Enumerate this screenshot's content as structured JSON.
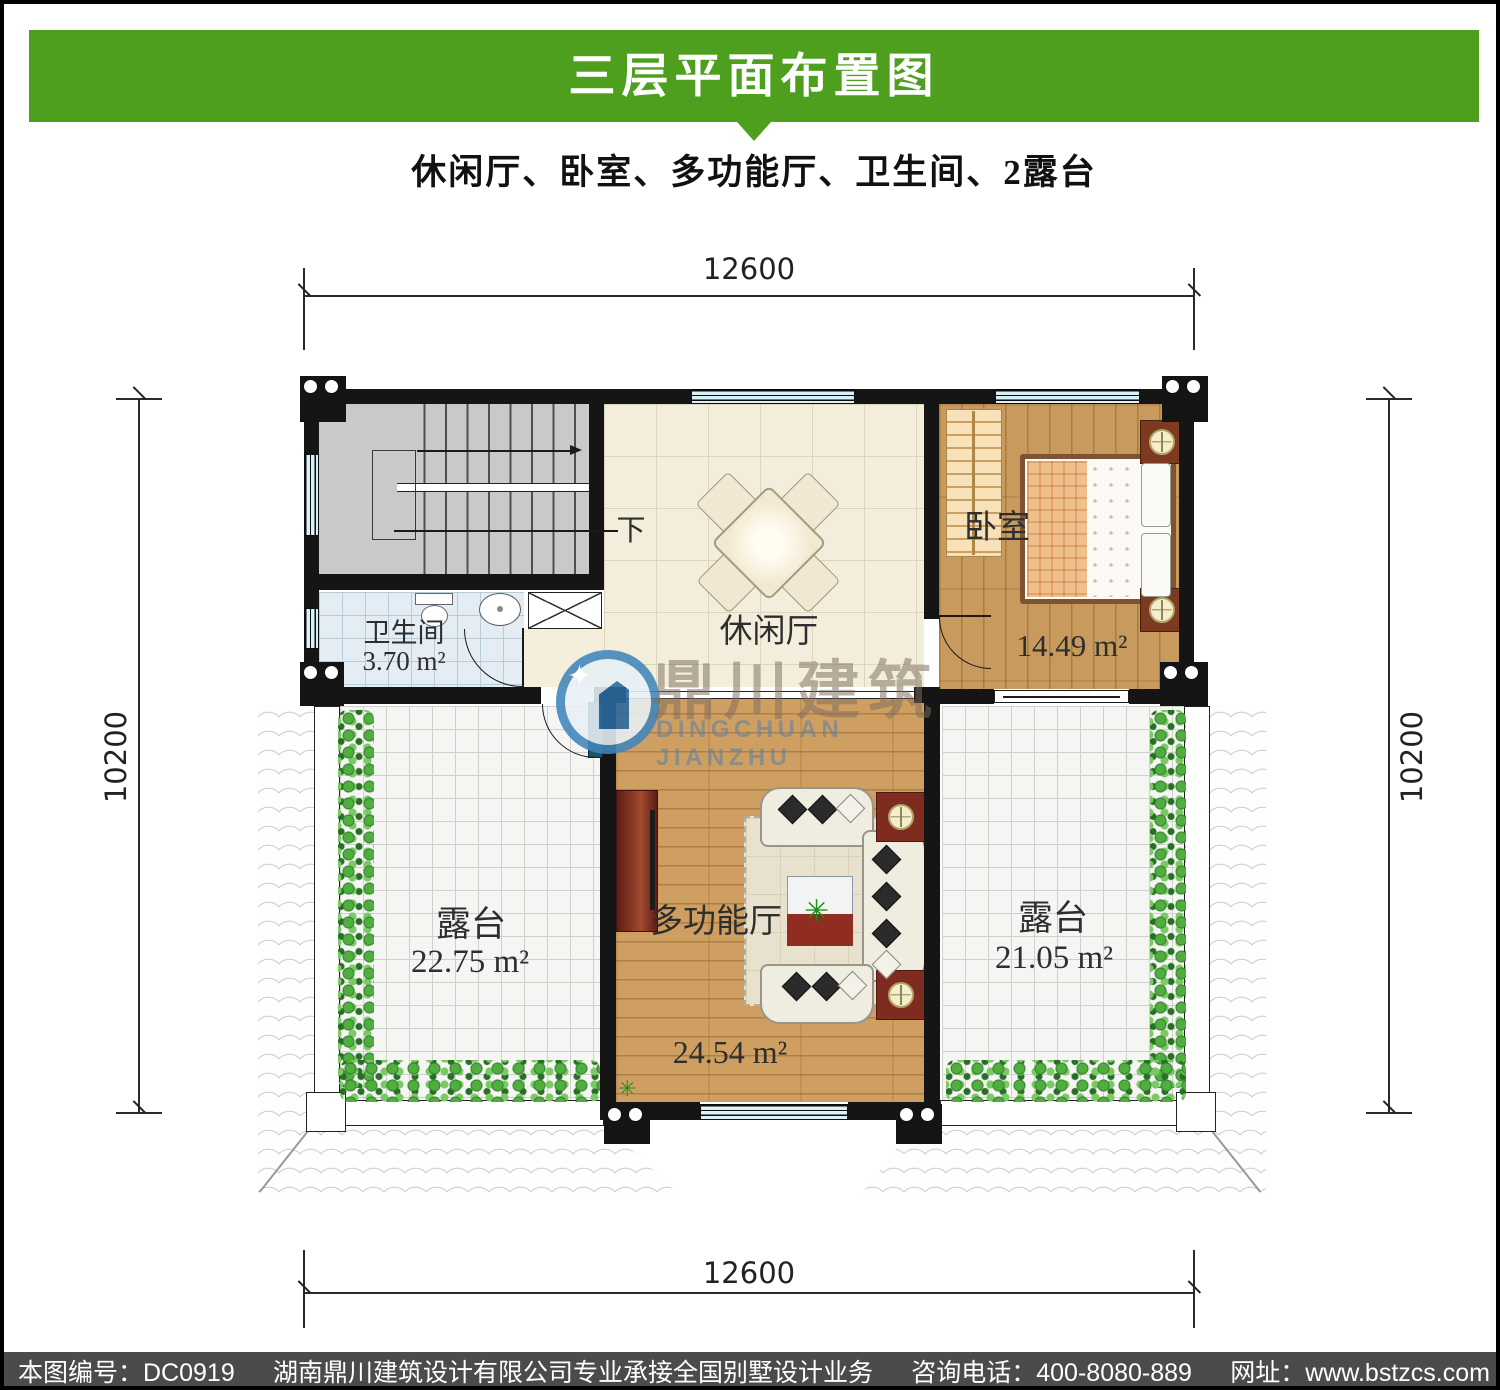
{
  "header": {
    "title": "三层平面布置图",
    "subtitle": "休闲厅、卧室、多功能厅、卫生间、2露台"
  },
  "plan": {
    "dimensions": {
      "top": "12600",
      "bottom": "12600",
      "left": "10200",
      "right": "10200"
    },
    "rooms": {
      "stairs": {
        "direction_label": "下"
      },
      "bathroom": {
        "name": "卫生间",
        "area": "3.70 m²"
      },
      "leisure": {
        "name": "休闲厅"
      },
      "bedroom": {
        "name": "卧室",
        "area": "14.49 m²"
      },
      "hall": {
        "name": "多功能厅",
        "area": "24.54 m²"
      },
      "terrace_left": {
        "name": "露台",
        "area": "22.75 m²"
      },
      "terrace_right": {
        "name": "露台",
        "area": "21.05 m²"
      }
    }
  },
  "watermark": {
    "cn": "鼎川建筑",
    "en": "DINGCHUAN JIANZHU"
  },
  "icons": {
    "plant": "✳",
    "sparkle": "✦"
  },
  "footer": {
    "segments": [
      "本图编号：DC0919",
      "湖南鼎川建筑设计有限公司专业承接全国别墅设计业务",
      "咨询电话：400-8080-889",
      "网址：www.bstzcs.com"
    ]
  },
  "colors": {
    "header_green": "#4f9f1f",
    "footer_gray": "#4b4b4b",
    "wall_black": "#151515",
    "window_cyan": "#d8f0f6",
    "wood_floor": "#cf9f62",
    "logo_blue": "#4186ba"
  }
}
